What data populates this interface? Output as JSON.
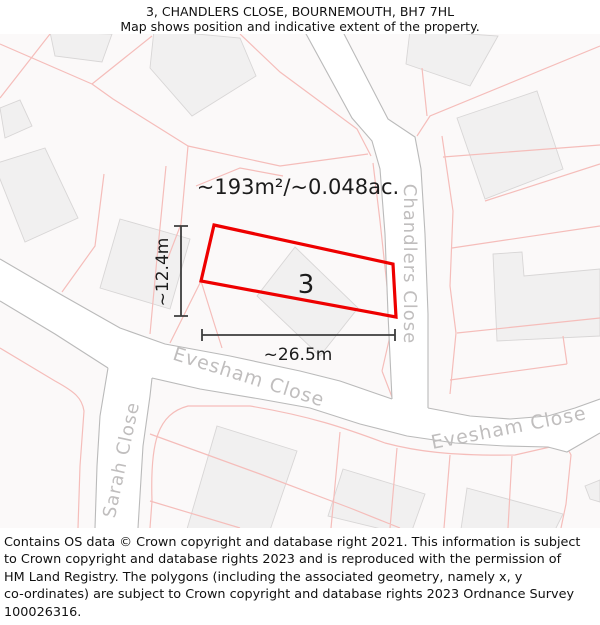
{
  "header": {
    "title": "3, CHANDLERS CLOSE, BOURNEMOUTH, BH7 7HL",
    "subtitle": "Map shows position and indicative extent of the property."
  },
  "map": {
    "area_label": "~193m²/~0.048ac.",
    "plot_number": "3",
    "width_label": "~26.5m",
    "height_label": "~12.4m",
    "streets": {
      "chandlers": "Chandlers Close",
      "evesham_west": "Evesham Close",
      "evesham_east": "Evesham Close",
      "sarah": "Sarah Close"
    },
    "colors": {
      "plot_outline": "#ee0000",
      "parcel_line": "#f5bdba",
      "road_edge": "#bababa",
      "building_fill": "#f1f0f0",
      "building_stroke": "#d8d6d6",
      "street_label": "#c0bebe",
      "dimension": "#3d3d3d",
      "map_bg": "#fbf9f9"
    }
  },
  "footer": {
    "lines": [
      "Contains OS data © Crown copyright and database right 2021. This information is subject",
      "to Crown copyright and database rights 2023 and is reproduced with the permission of",
      "HM Land Registry. The polygons (including the associated geometry, namely x, y",
      "co-ordinates) are subject to Crown copyright and database rights 2023 Ordnance Survey",
      "100026316."
    ]
  }
}
